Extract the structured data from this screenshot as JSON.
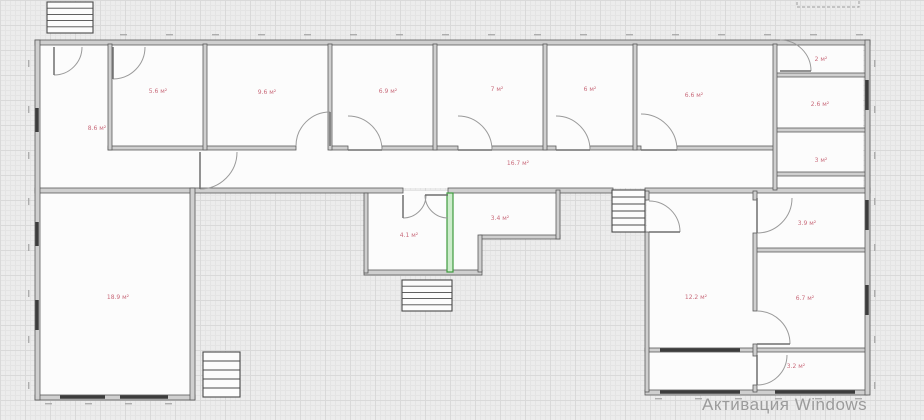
{
  "app": {
    "watermark": "Активация Windows"
  },
  "colors": {
    "background": "#ececec",
    "grid_minor": "#e4e4e4",
    "grid_major": "#d9d9d9",
    "room_fill": "#fcfcfc",
    "wall_fill": "#cfcfcf",
    "wall_edge": "#5a5a5a",
    "window": "#3c3c3c",
    "door": "#9a9a9a",
    "door_leaf": "#6f6f6f",
    "selected_wall_fill": "#cdeccc",
    "selected_wall_edge": "#3f9b3f",
    "room_label": "#c96b7b",
    "dim": "#9a9a9a",
    "stair_edge": "#4a4a4a",
    "watermark": "#9b9b9b"
  },
  "rooms": [
    {
      "name": "hall-left",
      "area": "8.6 м²",
      "x": 97,
      "y": 130
    },
    {
      "name": "room-1",
      "area": "5.6 м²",
      "x": 158,
      "y": 93
    },
    {
      "name": "room-2",
      "area": "9.6 м²",
      "x": 267,
      "y": 94
    },
    {
      "name": "room-3",
      "area": "6.9 м²",
      "x": 388,
      "y": 93
    },
    {
      "name": "room-4",
      "area": "7 м²",
      "x": 497,
      "y": 91
    },
    {
      "name": "room-5",
      "area": "6 м²",
      "x": 590,
      "y": 91
    },
    {
      "name": "room-6",
      "area": "6.6 м²",
      "x": 694,
      "y": 97
    },
    {
      "name": "room-7",
      "area": "2 м²",
      "x": 821,
      "y": 61
    },
    {
      "name": "room-8",
      "area": "2.6 м²",
      "x": 820,
      "y": 106
    },
    {
      "name": "room-9",
      "area": "3 м²",
      "x": 821,
      "y": 162
    },
    {
      "name": "corridor",
      "area": "16.7 м²",
      "x": 518,
      "y": 165
    },
    {
      "name": "room-10",
      "area": "4.1 м²",
      "x": 409,
      "y": 237
    },
    {
      "name": "room-11",
      "area": "3.4 м²",
      "x": 500,
      "y": 220
    },
    {
      "name": "room-12",
      "area": "18.9 м²",
      "x": 118,
      "y": 299
    },
    {
      "name": "room-13",
      "area": "12.2 м²",
      "x": 696,
      "y": 299
    },
    {
      "name": "room-14",
      "area": "3.9 м²",
      "x": 807,
      "y": 225
    },
    {
      "name": "room-15",
      "area": "6.7 м²",
      "x": 805,
      "y": 300
    },
    {
      "name": "room-16",
      "area": "3.2 м²",
      "x": 796,
      "y": 368
    }
  ],
  "plan": {
    "floors": [
      [
        37,
        44,
        826,
        144
      ],
      [
        37,
        191,
        153,
        204
      ],
      [
        366,
        191,
        190,
        44
      ],
      [
        366,
        191,
        112,
        79
      ],
      [
        647,
        191,
        218,
        199
      ]
    ],
    "walls": [
      [
        35,
        40,
        835,
        5
      ],
      [
        108,
        146,
        188,
        4
      ],
      [
        330,
        146,
        18,
        4
      ],
      [
        382,
        146,
        76,
        4
      ],
      [
        492,
        146,
        64,
        4
      ],
      [
        590,
        146,
        51,
        4
      ],
      [
        677,
        146,
        98,
        4
      ],
      [
        35,
        188,
        368,
        5
      ],
      [
        448,
        188,
        165,
        5
      ],
      [
        645,
        188,
        225,
        5
      ],
      [
        364,
        270,
        118,
        5
      ],
      [
        480,
        235,
        80,
        4
      ],
      [
        775,
        73,
        92,
        4
      ],
      [
        775,
        128,
        92,
        4
      ],
      [
        775,
        172,
        92,
        4
      ],
      [
        755,
        248,
        112,
        4
      ],
      [
        645,
        348,
        222,
        4
      ],
      [
        645,
        390,
        222,
        5
      ],
      [
        35,
        395,
        160,
        5
      ],
      [
        35,
        40,
        5,
        360
      ],
      [
        108,
        44,
        4,
        106
      ],
      [
        203,
        44,
        4,
        106
      ],
      [
        328,
        44,
        4,
        106
      ],
      [
        433,
        44,
        4,
        106
      ],
      [
        543,
        44,
        4,
        106
      ],
      [
        633,
        44,
        4,
        106
      ],
      [
        773,
        44,
        4,
        146
      ],
      [
        865,
        40,
        5,
        355
      ],
      [
        190,
        188,
        5,
        212
      ],
      [
        364,
        193,
        4,
        80
      ],
      [
        556,
        190,
        4,
        49
      ],
      [
        478,
        235,
        4,
        37
      ],
      [
        645,
        191,
        4,
        9
      ],
      [
        645,
        232,
        4,
        160
      ],
      [
        753,
        191,
        4,
        9
      ],
      [
        753,
        233,
        4,
        78
      ],
      [
        753,
        344,
        4,
        12
      ],
      [
        753,
        385,
        4,
        7
      ]
    ],
    "selected_wall": {
      "x": 447,
      "y": 193,
      "w": 6,
      "h": 79
    },
    "windows": [
      [
        37,
        108,
        37,
        132
      ],
      [
        37,
        222,
        37,
        246
      ],
      [
        37,
        300,
        37,
        330
      ],
      [
        60,
        397,
        105,
        397
      ],
      [
        120,
        397,
        168,
        397
      ],
      [
        660,
        392,
        740,
        392
      ],
      [
        775,
        392,
        855,
        392
      ],
      [
        867,
        80,
        867,
        110
      ],
      [
        867,
        200,
        867,
        230
      ],
      [
        867,
        285,
        867,
        315
      ],
      [
        660,
        350,
        740,
        350
      ]
    ],
    "doors": [
      {
        "cx": 54,
        "cy": 47,
        "r": 28,
        "a0": 0,
        "a1": 90
      },
      {
        "cx": 113,
        "cy": 47,
        "r": 32,
        "a0": 0,
        "a1": 90
      },
      {
        "cx": 330,
        "cy": 146,
        "r": 34,
        "a0": 180,
        "a1": 270
      },
      {
        "cx": 348,
        "cy": 150,
        "r": 34,
        "a0": 270,
        "a1": 360
      },
      {
        "cx": 458,
        "cy": 150,
        "r": 34,
        "a0": 270,
        "a1": 360
      },
      {
        "cx": 556,
        "cy": 150,
        "r": 34,
        "a0": 270,
        "a1": 360
      },
      {
        "cx": 641,
        "cy": 150,
        "r": 36,
        "a0": 270,
        "a1": 360
      },
      {
        "cx": 780,
        "cy": 71,
        "r": 31,
        "a0": 270,
        "a1": 360
      },
      {
        "cx": 757,
        "cy": 198,
        "r": 35,
        "a0": 0,
        "a1": 90
      },
      {
        "cx": 757,
        "cy": 344,
        "r": 33,
        "a0": 270,
        "a1": 360
      },
      {
        "cx": 757,
        "cy": 355,
        "r": 30,
        "a0": 0,
        "a1": 90
      },
      {
        "cx": 403,
        "cy": 195,
        "r": 23,
        "a0": 0,
        "a1": 90
      },
      {
        "cx": 448,
        "cy": 195,
        "r": 23,
        "a0": 90,
        "a1": 180
      },
      {
        "cx": 649,
        "cy": 232,
        "r": 31,
        "a0": 270,
        "a1": 360
      },
      {
        "cx": 200,
        "cy": 152,
        "r": 37,
        "a0": 0,
        "a1": 90
      }
    ],
    "stairs": [
      {
        "x": 47,
        "y": 2,
        "w": 46,
        "h": 31,
        "steps": 4
      },
      {
        "x": 402,
        "y": 280,
        "w": 50,
        "h": 31,
        "steps": 4
      },
      {
        "x": 612,
        "y": 190,
        "w": 33,
        "h": 42,
        "steps": 5
      },
      {
        "x": 203,
        "y": 352,
        "w": 37,
        "h": 45,
        "steps": 4
      }
    ],
    "dashed_rect": {
      "x": 797,
      "y": -2,
      "w": 62,
      "h": 9
    }
  }
}
